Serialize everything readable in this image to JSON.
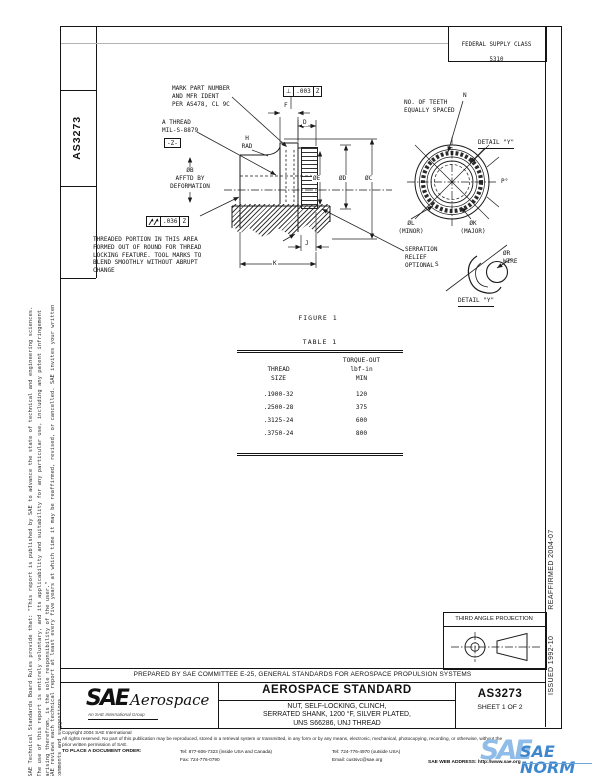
{
  "sheet": {
    "fsc_line1": "FEDERAL SUPPLY CLASS",
    "fsc_line2": "5310",
    "doc_number_side": "AS3273",
    "disclaimer_1": "SAE Technical Standards Board Rules provide that: \"This report is published by SAE to advance the state of technical and engineering sciences. The use of this report is entirely voluntary, and its applicability and suitability for any particular use, including any patent infringement arising therefrom, is the sole responsibility of the user.\"",
    "disclaimer_2": "SAE reviews each technical report at least every five years at which time it may be reaffirmed, revised, or cancelled. SAE invites your written comments and suggestions.",
    "issued": "ISSUED 1992-10",
    "reaffirmed": "REAFFIRMED 2004-07"
  },
  "drawing": {
    "mark_note": "MARK PART NUMBER\nAND MFR IDENT\nPER AS478, CL 9C",
    "thread_note": "A THREAD\nMIL-S-8879",
    "datum_flag": "-Z-",
    "perp_symbol": "⊥",
    "perp_value": ".003",
    "perp_datum": "Z",
    "runout_value": ".036",
    "runout_datum": "Z",
    "h_rad": "H\nRAD",
    "dia_b_note": "ØB\nAFFTD BY\nDEFORMATION",
    "threaded_note": "THREADED PORTION IN THIS AREA\nFORMED OUT OF ROUND FOR THREAD\nLOCKING FEATURE. TOOL MARKS TO\nBLEND SMOOTHLY WITHOUT ABRUPT\nCHANGE",
    "serration_note": "SERRATION\nRELIEF\nOPTIONAL",
    "teeth_note": "NO. OF TEETH\nEQUALLY SPACED",
    "n_label": "N",
    "detail_callout": "DETAIL \"Y\"",
    "detail_label": "DETAIL \"Y\"",
    "figure_caption": "FIGURE 1",
    "dims": {
      "f": "F",
      "d": "D",
      "j": "J",
      "k": "K",
      "p": "P°",
      "s": "S",
      "dia_e": "ØE",
      "dia_d": "ØD",
      "dia_c": "ØC",
      "dia_l": "ØL\n(MINOR)",
      "dia_k": "ØK\n(MAJOR)",
      "dia_r": "ØR\nWIRE"
    }
  },
  "table": {
    "caption": "TABLE 1",
    "header_col1": "THREAD\nSIZE",
    "header_col2": "TORQUE-OUT\nlbf-in\nMIN",
    "rows": [
      {
        "size": ".1900-32",
        "torque": "120"
      },
      {
        "size": ".2500-28",
        "torque": "375"
      },
      {
        "size": ".3125-24",
        "torque": "600"
      },
      {
        "size": ".3750-24",
        "torque": "800"
      }
    ]
  },
  "projection": {
    "title": "THIRD ANGLE PROJECTION"
  },
  "title_block": {
    "prepared_by": "PREPARED BY SAE COMMITTEE E-25, GENERAL STANDARDS FOR AEROSPACE PROPULSION SYSTEMS",
    "logo_sae": "SAE",
    "logo_aerospace": "Aerospace",
    "logo_tagline": "An SAE International Group",
    "standard_type": "AEROSPACE STANDARD",
    "title": "NUT, SELF-LOCKING, CLINCH,\nSERRATED SHANK, 1200 °F, SILVER PLATED,\nUNS S66286, UNJ THREAD",
    "doc_number": "AS3273",
    "sheet_label": "SHEET 1 OF 2"
  },
  "footer": {
    "copyright": "Copyright 2004 SAE International",
    "rights": "All rights reserved. No part of this publication may be reproduced, stored in a retrieval system or transmitted, in any form or by any means, electronic, mechanical, photocopying, recording, or otherwise, without the prior written permission of SAE.",
    "order_label": "TO PLACE A DOCUMENT ORDER:",
    "tel_inside": "Tel: 877-606-7323 (inside USA and Canada)",
    "tel_outside": "Tel: 724-776-4970 (outside USA)",
    "fax": "Fax: 724-776-0790",
    "email": "Email: custsvc@sae.org",
    "web": "SAE WEB ADDRESS: http://www.sae.org",
    "norm_sae": "SAE",
    "norm_text": "SAE NORM"
  },
  "colors": {
    "line": "#151515",
    "norm_blue": "#3f87cc",
    "norm_light_blue": "#8fbce8"
  }
}
